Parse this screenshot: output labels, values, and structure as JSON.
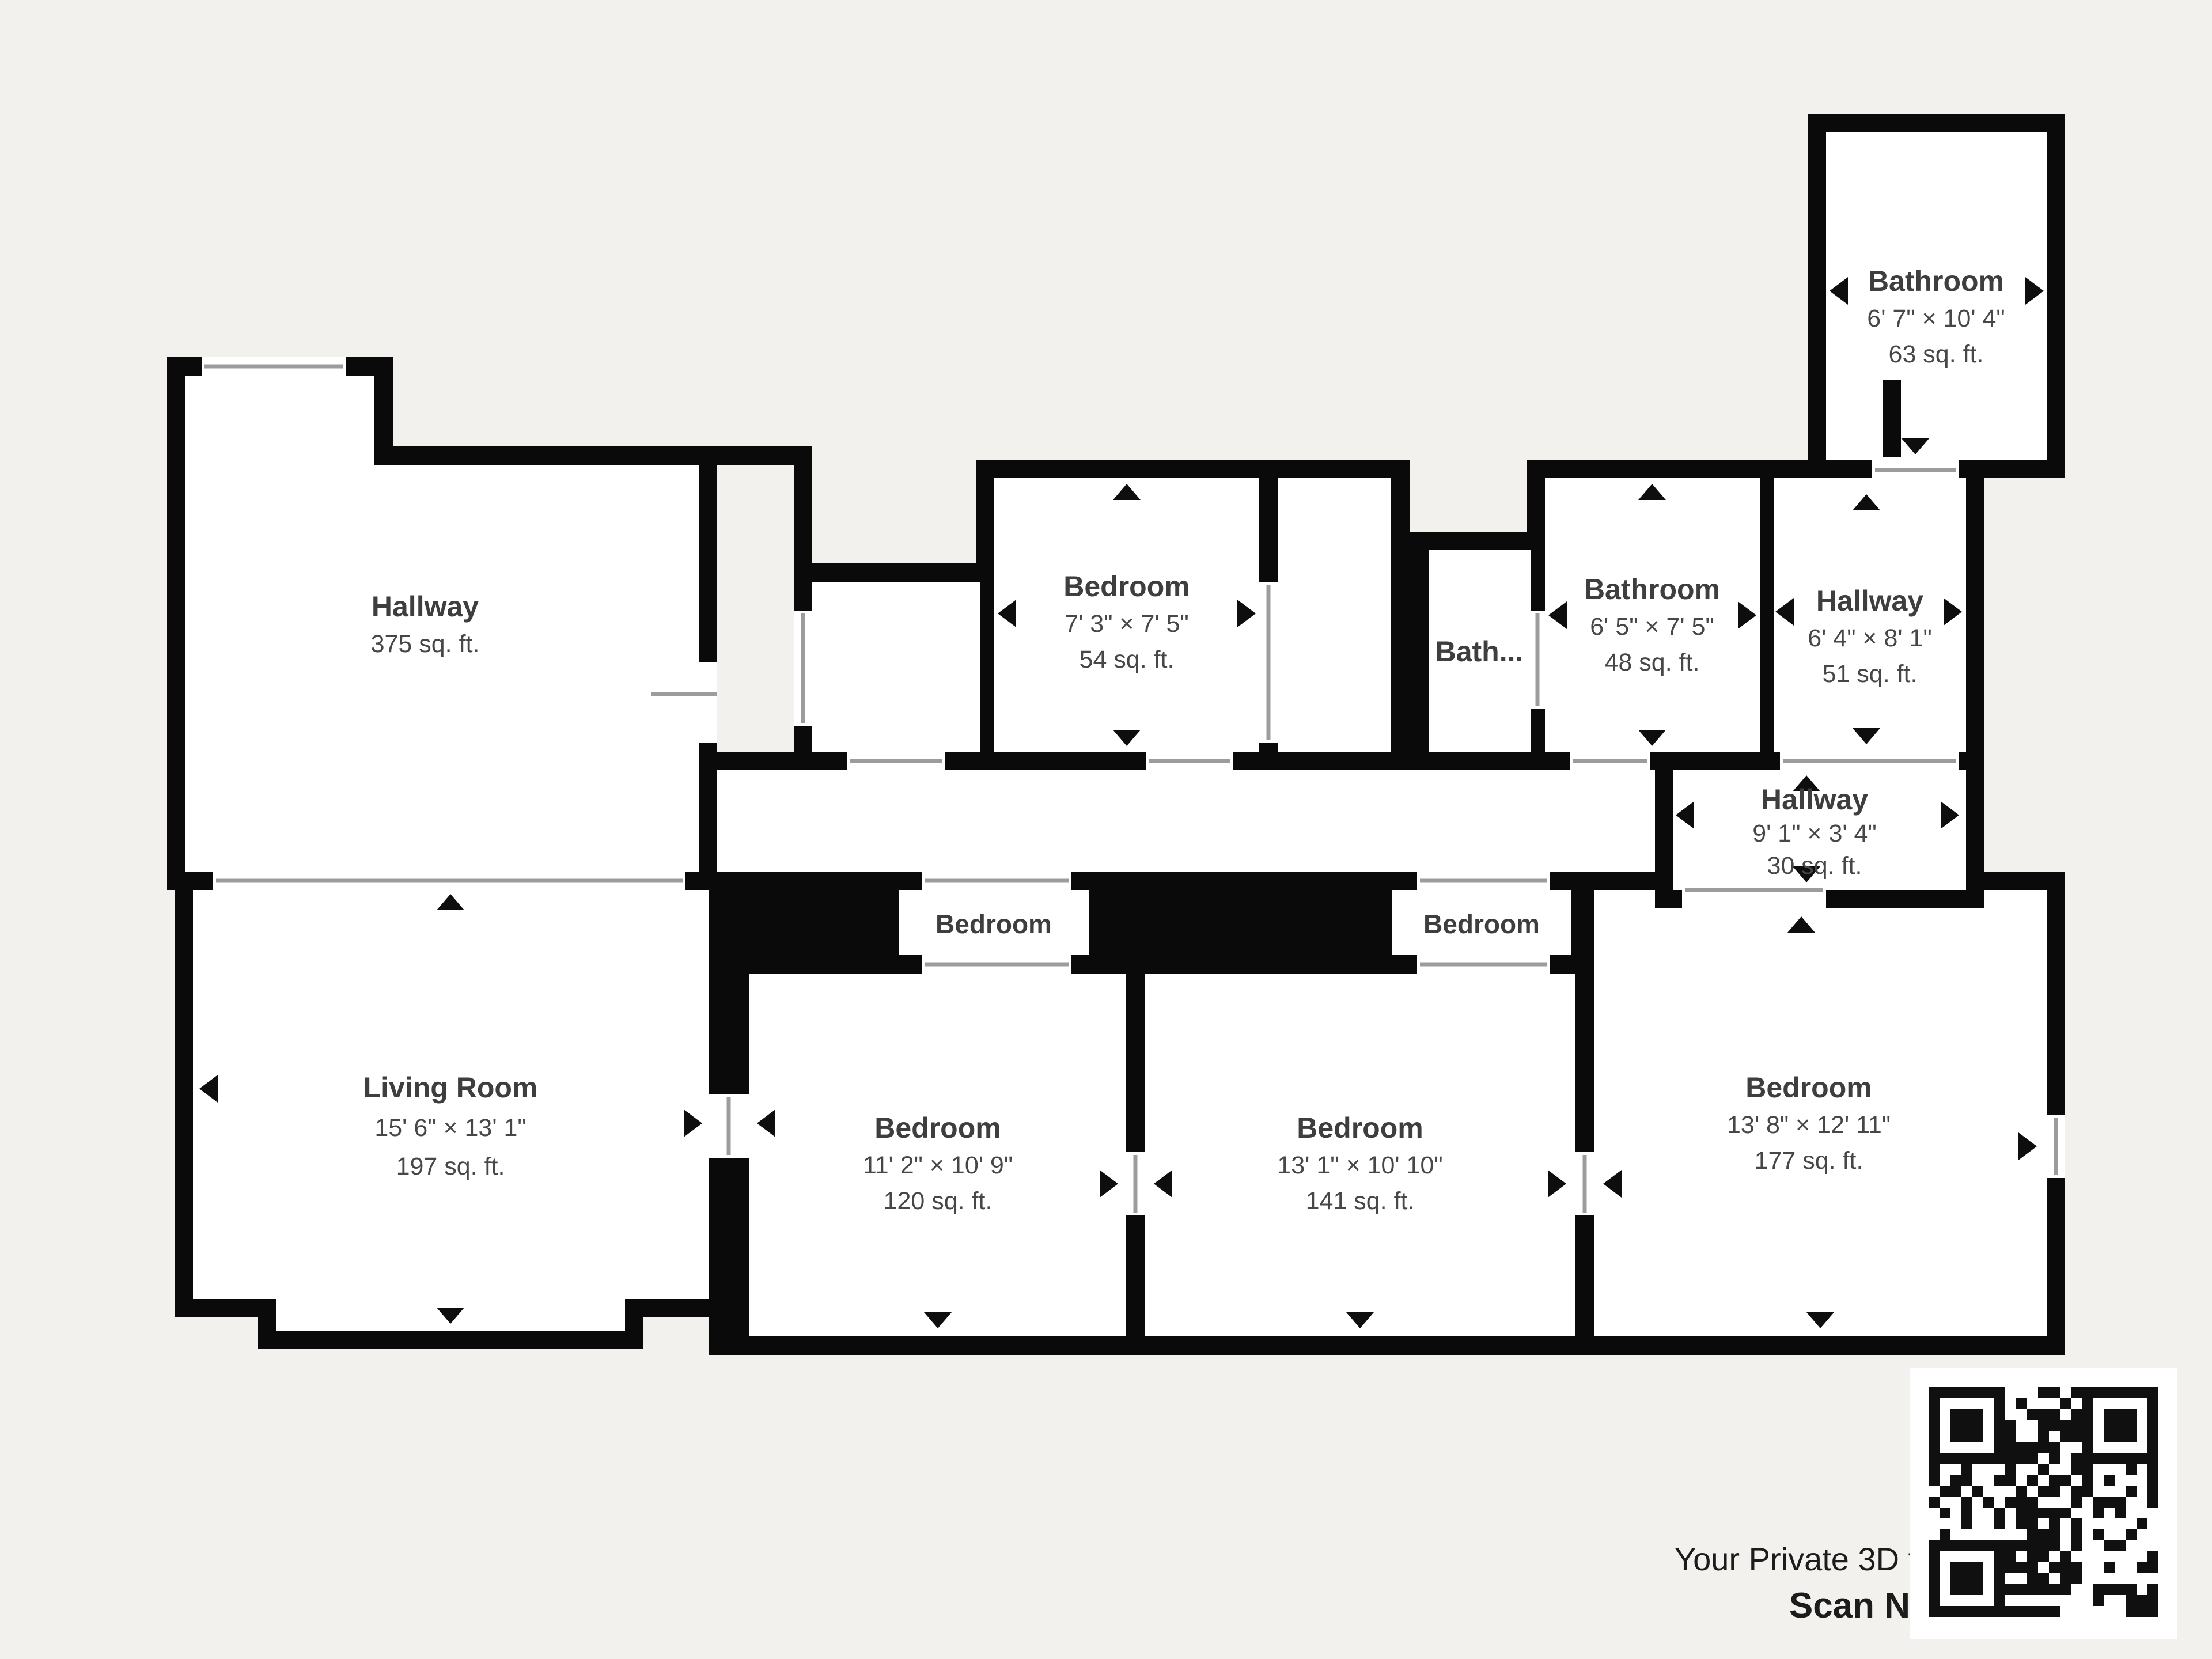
{
  "colors": {
    "background": "#f2f1ee",
    "wall": "#0a0a0a",
    "room_fill": "#ffffff",
    "label": "#3e3e3e",
    "footer_text": "#1c1c1c"
  },
  "rooms": [
    {
      "id": "hallway-main",
      "name": "Hallway",
      "dims": "",
      "area": "375 sq. ft."
    },
    {
      "id": "bedroom-top",
      "name": "Bedroom",
      "dims": "7' 3\" × 7' 5\"",
      "area": "54 sq. ft."
    },
    {
      "id": "bath-small",
      "name": "Bath...",
      "dims": "",
      "area": ""
    },
    {
      "id": "bathroom-middle",
      "name": "Bathroom",
      "dims": "6' 5\" × 7' 5\"",
      "area": "48 sq. ft."
    },
    {
      "id": "hallway-upper",
      "name": "Hallway",
      "dims": "6' 4\" × 8' 1\"",
      "area": "51 sq. ft."
    },
    {
      "id": "hallway-lower",
      "name": "Hallway",
      "dims": "9' 1\" × 3' 4\"",
      "area": "30 sq. ft."
    },
    {
      "id": "bathroom-ensuite",
      "name": "Bathroom",
      "dims": "6' 7\" × 10' 4\"",
      "area": "63 sq. ft."
    },
    {
      "id": "living-room",
      "name": "Living Room",
      "dims": "15' 6\" × 13' 1\"",
      "area": "197 sq. ft."
    },
    {
      "id": "bedroom-left",
      "name": "Bedroom",
      "dims": "11' 2\" × 10' 9\"",
      "area": "120 sq. ft."
    },
    {
      "id": "bedroom-middle",
      "name": "Bedroom",
      "dims": "13' 1\" × 10' 10\"",
      "area": "141 sq. ft."
    },
    {
      "id": "bedroom-right",
      "name": "Bedroom",
      "dims": "13' 8\" × 12' 11\"",
      "area": "177 sq. ft."
    },
    {
      "id": "bedroom-closet-a",
      "name": "Bedroom"
    },
    {
      "id": "bedroom-closet-b",
      "name": "Bedroom"
    }
  ],
  "footer": {
    "line1": "Your Private 3D tour Awaits,",
    "line2": "Scan Now"
  }
}
